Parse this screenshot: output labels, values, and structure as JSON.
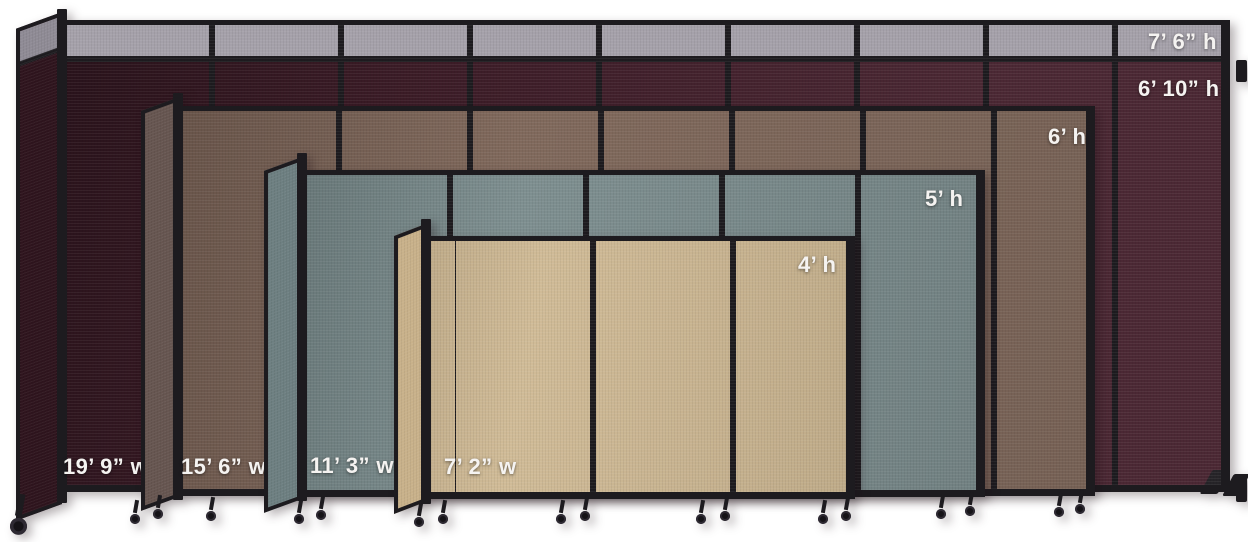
{
  "frame_color": "#1d1b1f",
  "background_color": "#ffffff",
  "label_text_color": "#f5f3f1",
  "icons": {
    "caster_wheel": "css-circle-with-stem",
    "wall_bracket": "css-rect-tab"
  },
  "dividers": [
    {
      "id": "cranberry",
      "top_panel_height_label": "7’ 6” h",
      "height_label": "6’ 10” h",
      "width_label": "19’ 9” w",
      "colors": {
        "fabric": "#44202c",
        "return_fabric": "#2e141d",
        "top_band": "#a5a1aa",
        "top_band_return": "#8f8b95"
      }
    },
    {
      "id": "mocha",
      "height_label": "6’ h",
      "width_label": "15’ 6” w",
      "colors": {
        "fabric": "#80695c",
        "return_fabric": "#665550"
      }
    },
    {
      "id": "slate",
      "height_label": "5’ h",
      "width_label": "11’ 3” w",
      "colors": {
        "fabric": "#7e8f90",
        "return_fabric": "#6d7f81"
      }
    },
    {
      "id": "sand",
      "height_label": "4’ h",
      "width_label": "7’ 2” w",
      "colors": {
        "fabric": "#d0bb97",
        "return_fabric": "#c8b18a"
      }
    }
  ]
}
